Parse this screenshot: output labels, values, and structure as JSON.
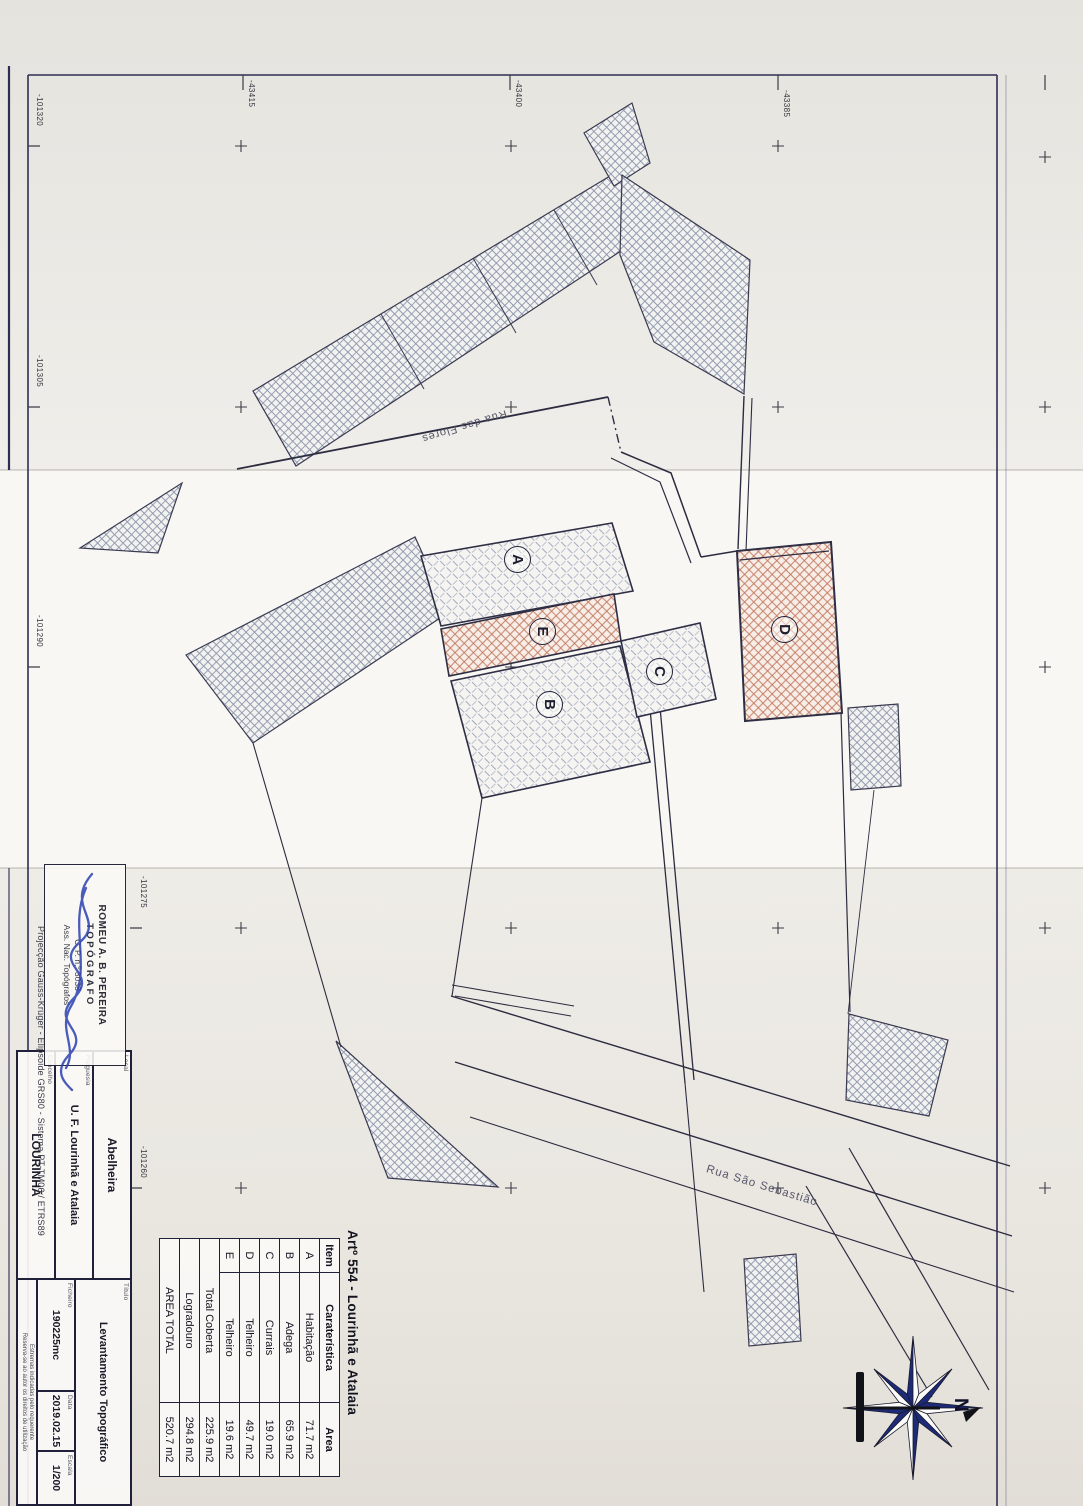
{
  "plan": {
    "title": "Artº 554 - Lourinhã e Atalaia",
    "buildings": [
      {
        "label": "A"
      },
      {
        "label": "B"
      },
      {
        "label": "C"
      },
      {
        "label": "D"
      },
      {
        "label": "E"
      }
    ],
    "streets": [
      {
        "name": "Rua das Flores"
      },
      {
        "name": "Rua São Sebastião"
      }
    ],
    "compass_north": "N"
  },
  "areas_table": {
    "headers": [
      "Item",
      "Caraterística",
      "Area"
    ],
    "rows": [
      {
        "item": "A",
        "caracteristica": "Habitação",
        "area": "71.7 m2"
      },
      {
        "item": "B",
        "caracteristica": "Adega",
        "area": "65.9 m2"
      },
      {
        "item": "C",
        "caracteristica": "Currais",
        "area": "19.0 m2"
      },
      {
        "item": "D",
        "caracteristica": "Telheiro",
        "area": "49.7 m2"
      },
      {
        "item": "E",
        "caracteristica": "Telheiro",
        "area": "19.6 m2"
      }
    ],
    "summary": [
      {
        "label": "Total Coberta",
        "area": "225.9 m2"
      },
      {
        "label": "Logradouro",
        "area": "294.8 m2"
      },
      {
        "label": "AREA TOTAL",
        "area": "520.7 m2"
      }
    ]
  },
  "title_block": {
    "local_label": "Local",
    "local": "Abelheira",
    "freguesia_label": "Freguesia",
    "freguesia": "U. F. Lourinhã e Atalaia",
    "concelho_label": "Concelho",
    "concelho": "LOURINHÃ",
    "titulo_label": "Título",
    "titulo": "Levantamento Topográfico",
    "ficheiro_label": "Ficheiro",
    "ficheiro": "190225mc",
    "data_label": "Data",
    "data": "2019.02.15",
    "escala_label": "Escala",
    "escala": "1/200",
    "notes": [
      "Estremas indicadas pelo requerente",
      "Reserva-se ao autor os direitos de utilização"
    ]
  },
  "stamp": {
    "line1": "ROMEU A. B. PEREIRA",
    "line2": "TOPÓGRAFO",
    "line3": "C. P. n.º 3038",
    "line4": "Ass. Nac. Topógrafos"
  },
  "projection_note": "Projecção Gauss-Krüger - Elipsoide GRS80 - Sistema PT-TM06 / ETRS89",
  "grid": {
    "left_labels": [
      "-101320",
      "-101305",
      "-101290",
      "-101275",
      "-101260"
    ],
    "top_labels": [
      "-43415",
      "-43400",
      "-43385"
    ]
  },
  "colors": {
    "neighbor_hatch": "#8f99ae",
    "building_hatch": "#a3aac0",
    "red_hatch": "#c0745a",
    "line": "#2c2c40",
    "frame": "#2e2e55",
    "signature_ink": "#2c41b0",
    "compass_navy": "#1c2a78"
  }
}
